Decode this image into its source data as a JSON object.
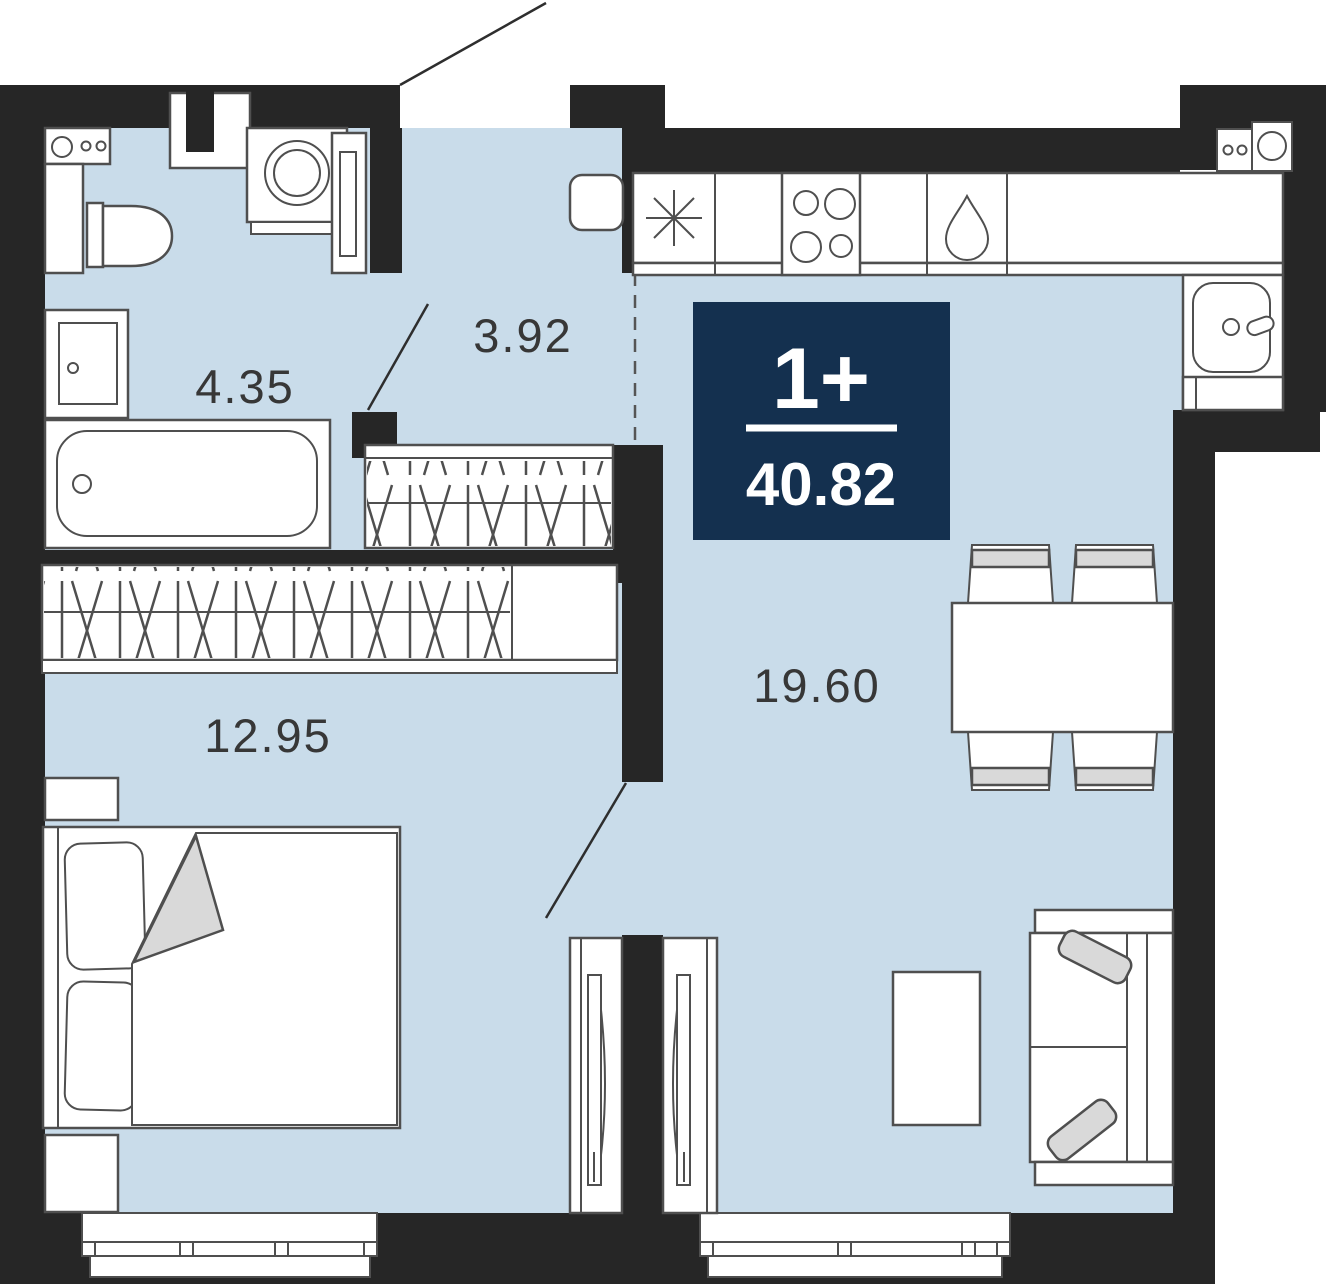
{
  "plan": {
    "title": "apartment-floor-plan",
    "badge": {
      "rooms_label": "1+",
      "total_area": "40.82"
    },
    "rooms": [
      {
        "name": "bathroom",
        "area": "4.35"
      },
      {
        "name": "hallway",
        "area": "3.92"
      },
      {
        "name": "bedroom",
        "area": "12.95"
      },
      {
        "name": "living-kitchen",
        "area": "19.60"
      }
    ],
    "colors": {
      "room_fill": "#c9dcea",
      "wall": "#262626",
      "badge_navy": "#14304f",
      "furniture_line": "#4f4f4f",
      "soft_gray": "#d9d9d9"
    },
    "fixtures": [
      "washbasin-counter",
      "toilet",
      "water-heater-cabinet",
      "bathtub",
      "washing-machine",
      "hall-wardrobe",
      "bedroom-wardrobe",
      "double-bed",
      "nightstands",
      "kitchen-counter",
      "fridge",
      "hob",
      "dishwasher-drop",
      "kitchen-sink",
      "dining-table",
      "chairs",
      "sofa",
      "coffee-table",
      "radiator-panels",
      "windows",
      "entrance-door",
      "interior-doors"
    ]
  }
}
